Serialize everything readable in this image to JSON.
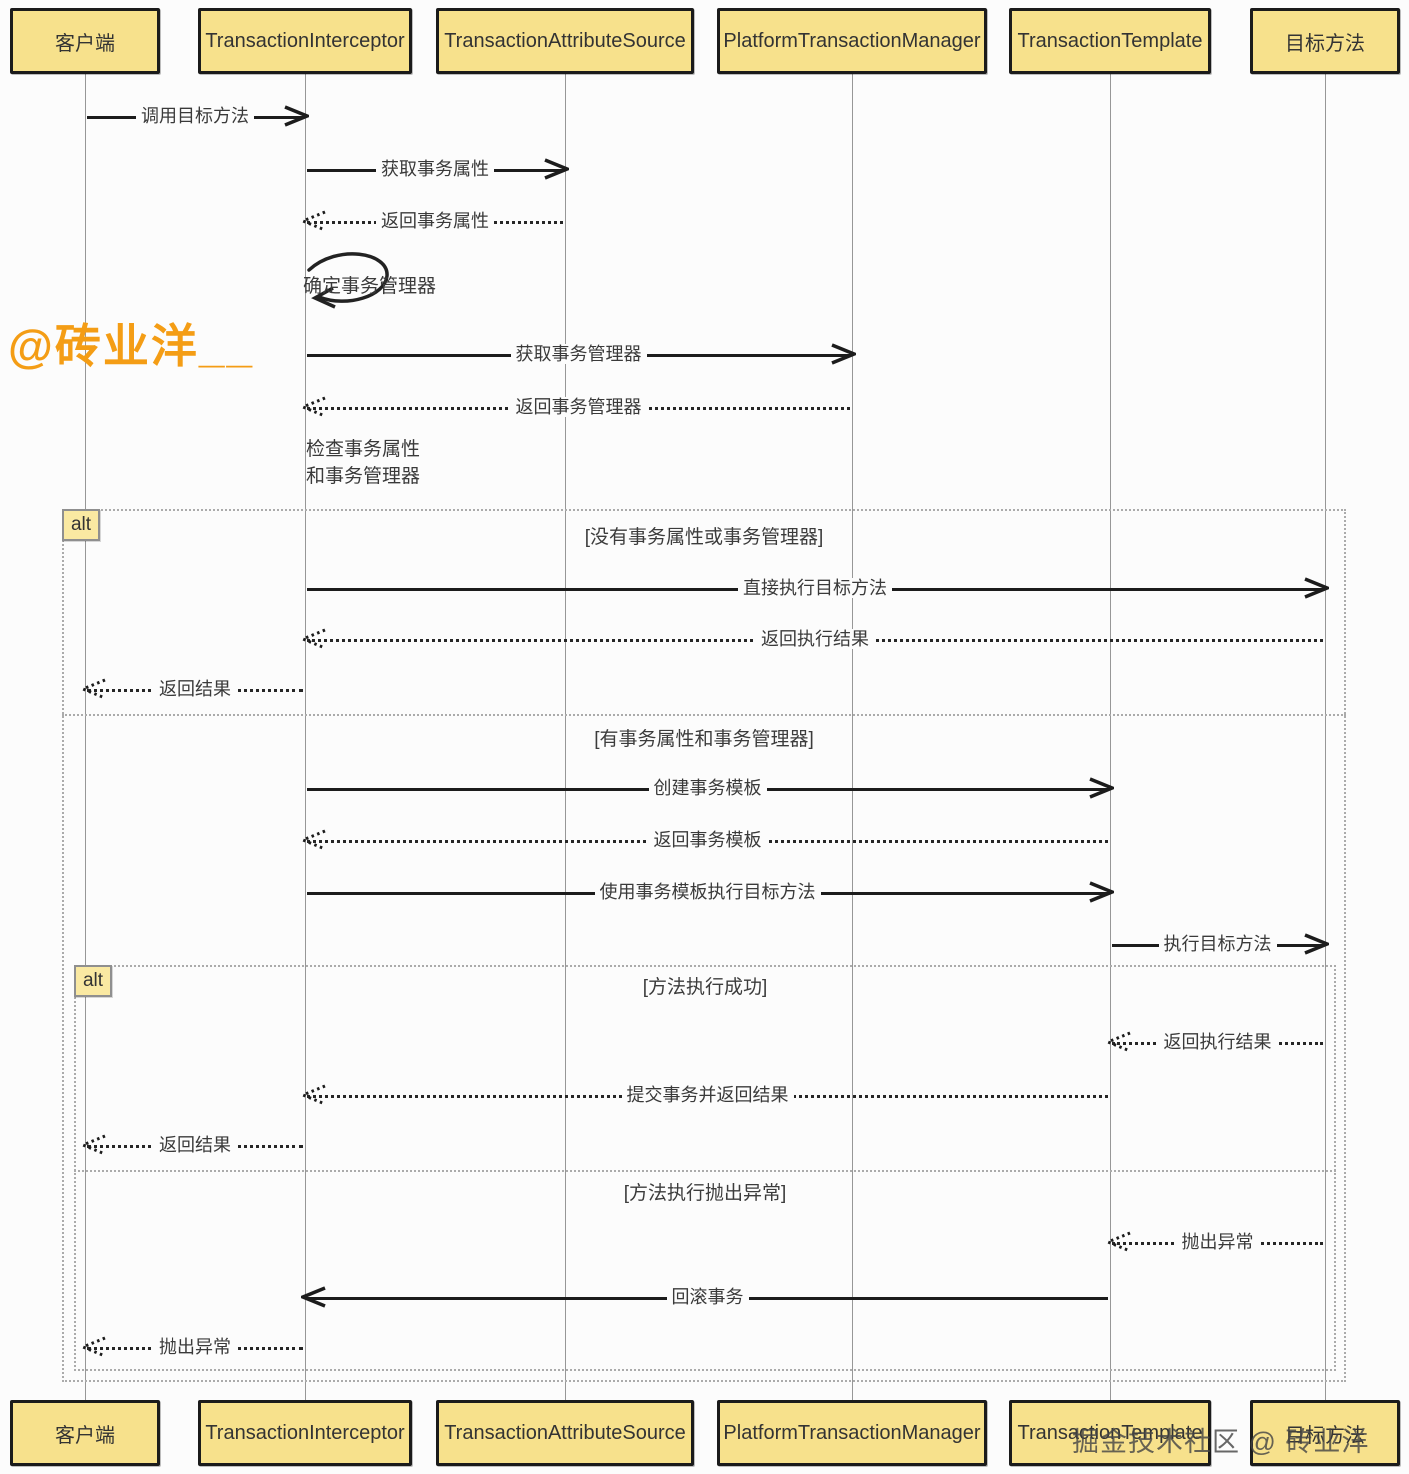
{
  "participants": [
    {
      "label": "客户端"
    },
    {
      "label": "TransactionInterceptor"
    },
    {
      "label": "TransactionAttributeSource"
    },
    {
      "label": "PlatformTransactionManager"
    },
    {
      "label": "TransactionTemplate"
    },
    {
      "label": "目标方法"
    }
  ],
  "frames": {
    "outer": {
      "operator": "alt",
      "guards": [
        "[没有事务属性或事务管理器]",
        "[有事务属性和事务管理器]"
      ]
    },
    "inner": {
      "operator": "alt",
      "guards": [
        "[方法执行成功]",
        "[方法执行抛出异常]"
      ]
    }
  },
  "self_message": {
    "label": "确定事务管理器"
  },
  "note": {
    "text": "检查事务属性\n和事务管理器"
  },
  "messages": [
    {
      "label": "调用目标方法",
      "type": "solid",
      "from": "客户端",
      "to": "TransactionInterceptor"
    },
    {
      "label": "获取事务属性",
      "type": "solid",
      "from": "TransactionInterceptor",
      "to": "TransactionAttributeSource"
    },
    {
      "label": "返回事务属性",
      "type": "dashed",
      "from": "TransactionAttributeSource",
      "to": "TransactionInterceptor"
    },
    {
      "label": "获取事务管理器",
      "type": "solid",
      "from": "TransactionInterceptor",
      "to": "PlatformTransactionManager"
    },
    {
      "label": "返回事务管理器",
      "type": "dashed",
      "from": "PlatformTransactionManager",
      "to": "TransactionInterceptor"
    },
    {
      "label": "直接执行目标方法",
      "type": "solid",
      "from": "TransactionInterceptor",
      "to": "目标方法"
    },
    {
      "label": "返回执行结果",
      "type": "dashed",
      "from": "目标方法",
      "to": "TransactionInterceptor"
    },
    {
      "label": "返回结果",
      "type": "dashed",
      "from": "TransactionInterceptor",
      "to": "客户端"
    },
    {
      "label": "创建事务模板",
      "type": "solid",
      "from": "TransactionInterceptor",
      "to": "TransactionTemplate"
    },
    {
      "label": "返回事务模板",
      "type": "dashed",
      "from": "TransactionTemplate",
      "to": "TransactionInterceptor"
    },
    {
      "label": "使用事务模板执行目标方法",
      "type": "solid",
      "from": "TransactionInterceptor",
      "to": "TransactionTemplate"
    },
    {
      "label": "执行目标方法",
      "type": "solid",
      "from": "TransactionTemplate",
      "to": "目标方法"
    },
    {
      "label": "返回执行结果",
      "type": "dashed",
      "from": "目标方法",
      "to": "TransactionTemplate"
    },
    {
      "label": "提交事务并返回结果",
      "type": "dashed",
      "from": "TransactionTemplate",
      "to": "TransactionInterceptor"
    },
    {
      "label": "返回结果",
      "type": "dashed",
      "from": "TransactionInterceptor",
      "to": "客户端"
    },
    {
      "label": "抛出异常",
      "type": "dashed",
      "from": "目标方法",
      "to": "TransactionTemplate"
    },
    {
      "label": "回滚事务",
      "type": "solid",
      "from": "TransactionTemplate",
      "to": "TransactionInterceptor"
    },
    {
      "label": "抛出异常",
      "type": "dashed",
      "from": "TransactionInterceptor",
      "to": "客户端"
    }
  ],
  "watermarks": {
    "author": "@砖业洋__",
    "footer": "掘金技术社区 @ 砖业洋"
  },
  "colors": {
    "participant_fill": "#F7E18C",
    "participant_border": "#1b1b1b",
    "alt_tag_fill": "#FAE9A2",
    "frame_border": "#ababab",
    "arrow": "#1c1c1c",
    "lifeline": "#979797",
    "watermark_orange": "#F49D15",
    "watermark_gray": "#464646"
  }
}
